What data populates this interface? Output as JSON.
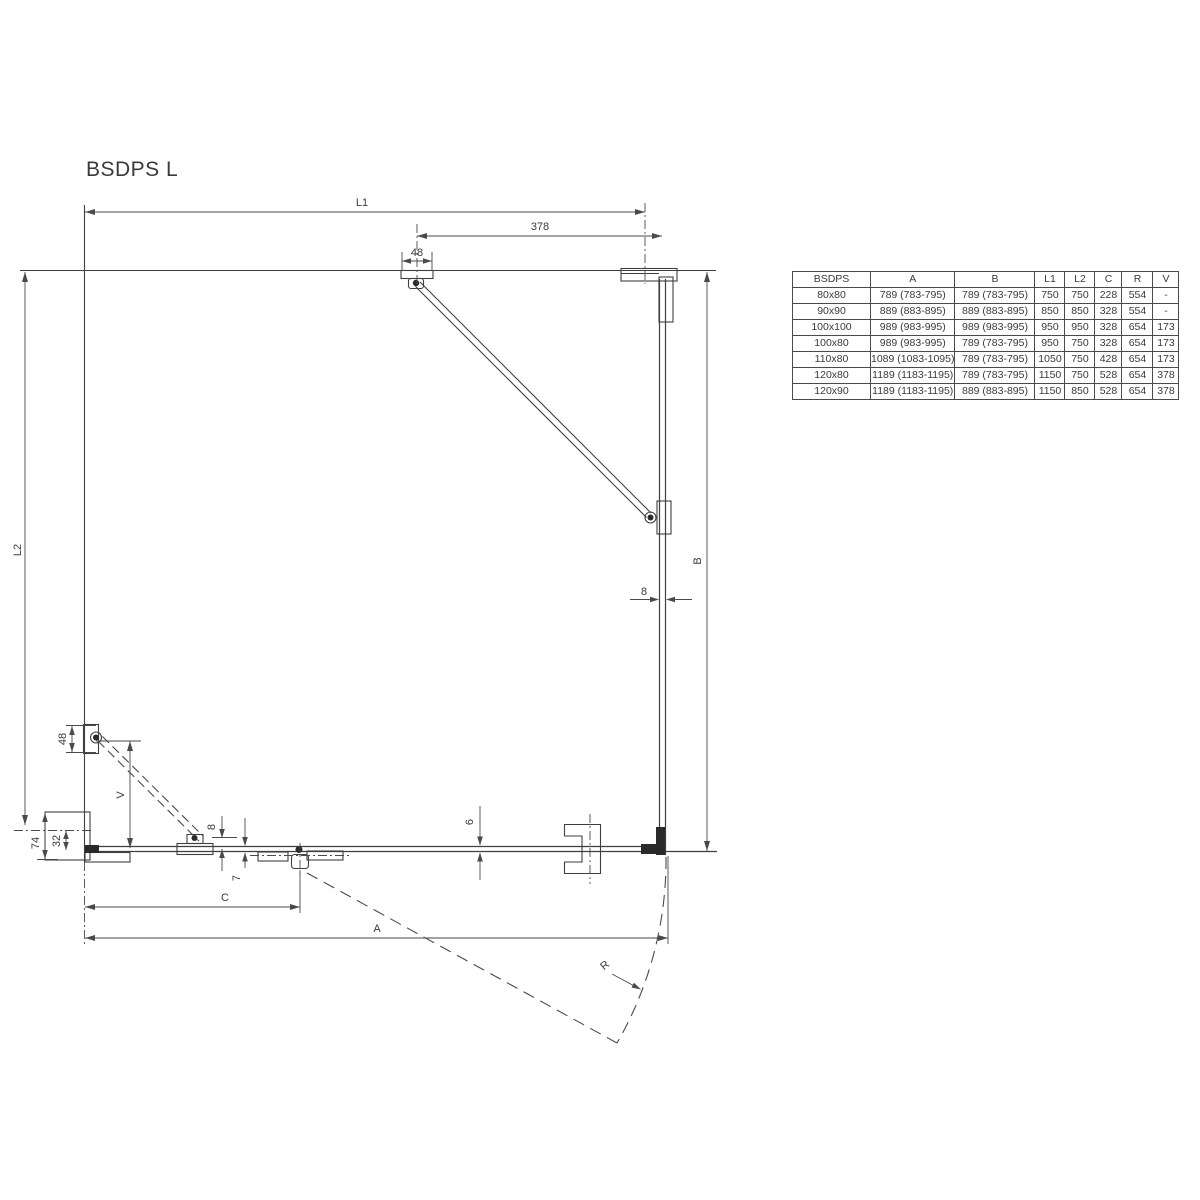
{
  "title": "BSDPS L",
  "diagram": {
    "labels": {
      "l1": "L1",
      "l2": "L2",
      "a": "A",
      "b": "B",
      "c": "C",
      "v": "V",
      "r": "R",
      "dim_378": "378",
      "dim_48_top": "48",
      "dim_48_left": "48",
      "dim_74": "74",
      "dim_32": "32",
      "dim_8_right": "8",
      "dim_8_bottom": "8",
      "dim_7": "7",
      "dim_6": "6"
    }
  },
  "table": {
    "headers": [
      "BSDPS",
      "A",
      "B",
      "L1",
      "L2",
      "C",
      "R",
      "V"
    ],
    "rows": [
      [
        "80x80",
        "789 (783-795)",
        "789 (783-795)",
        "750",
        "750",
        "228",
        "554",
        "-"
      ],
      [
        "90x90",
        "889 (883-895)",
        "889 (883-895)",
        "850",
        "850",
        "328",
        "554",
        "-"
      ],
      [
        "100x100",
        "989 (983-995)",
        "989 (983-995)",
        "950",
        "950",
        "328",
        "654",
        "173"
      ],
      [
        "100x80",
        "989 (983-995)",
        "789 (783-795)",
        "950",
        "750",
        "328",
        "654",
        "173"
      ],
      [
        "110x80",
        "1089 (1083-1095)",
        "789 (783-795)",
        "1050",
        "750",
        "428",
        "654",
        "173"
      ],
      [
        "120x80",
        "1189 (1183-1195)",
        "789 (783-795)",
        "1150",
        "750",
        "528",
        "654",
        "378"
      ],
      [
        "120x90",
        "1189 (1183-1195)",
        "889 (883-895)",
        "1150",
        "850",
        "528",
        "654",
        "378"
      ]
    ]
  }
}
